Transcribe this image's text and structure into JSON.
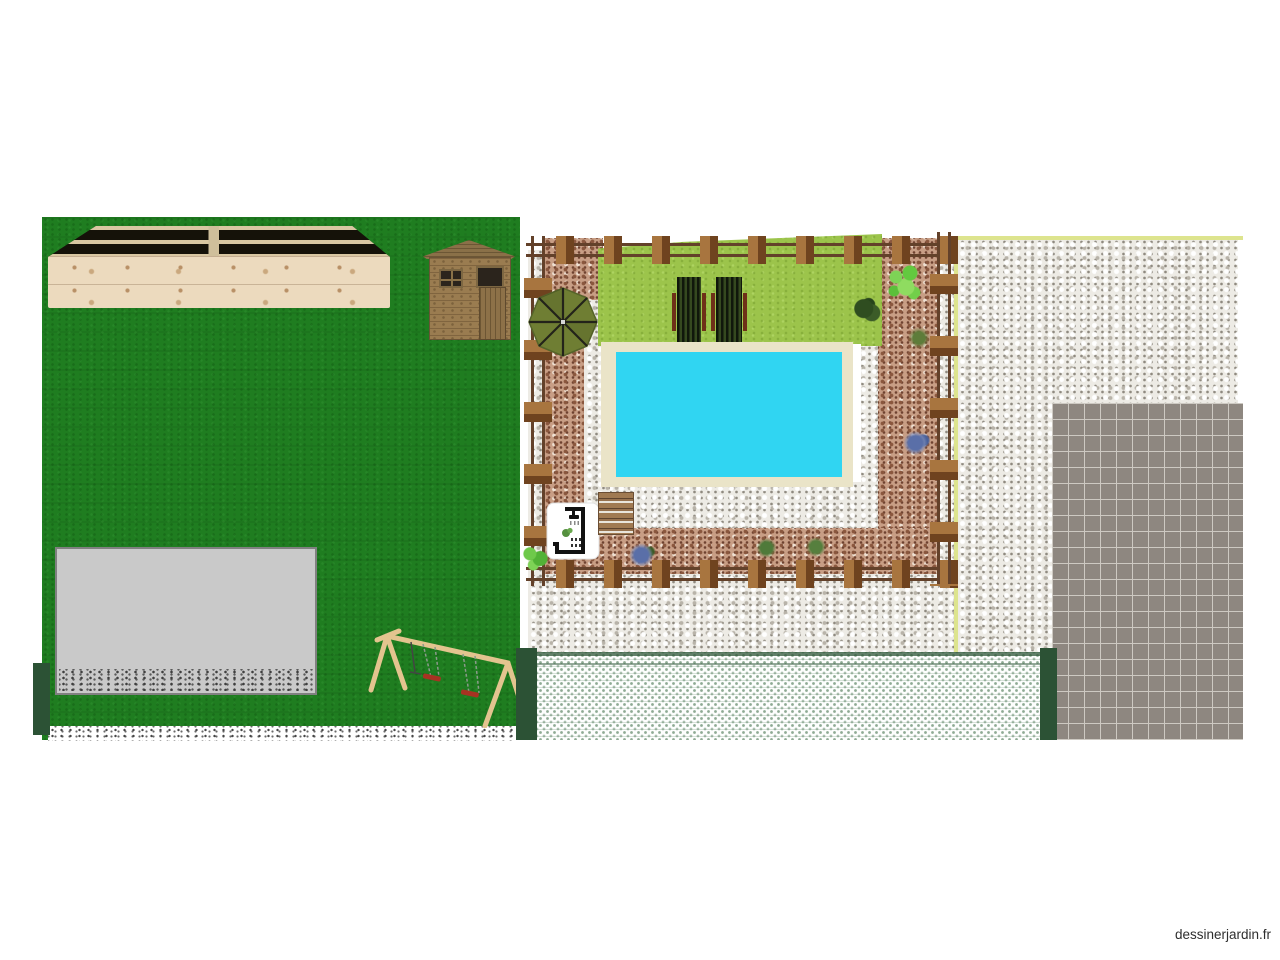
{
  "watermark": {
    "text": "dessinerjardin.fr"
  },
  "palette": {
    "lawn": "#1f7d20",
    "grass": "#9cc44b",
    "pool": "#30d5f2",
    "surround": "#eae4c8",
    "stone": "#edebe5",
    "mulch": "#c89e85",
    "railBar": "#63412a",
    "railPostLight": "#a8753f",
    "railPostDark": "#6f431f",
    "shedWood": "#9a7c50",
    "deckFace": "#ecdabe",
    "terrace": "#c9c9c9",
    "tiles": "#8e8780",
    "hedgeGreen": "#3d6b4a",
    "darkPost": "#2c5235",
    "swingWood": "#e3c48f",
    "seatRed": "#a83222",
    "parasol": "#6f7e33",
    "boundary": "#dde48e",
    "watermarkColor": "#2e2e2e"
  },
  "objects": {
    "lawn": "lawn",
    "raised_deck": "wooden raised deck",
    "shed": "garden shed",
    "pergola": "wooden pergola frame",
    "mulch_border": "bark mulch border",
    "gravel": "white gravel",
    "lawn_patch": "lawn patch",
    "loungers": "sun loungers",
    "pool": "swimming pool",
    "parasol": "parasol",
    "shower_card": "outdoor shower plan card",
    "pallet": "wood pallet",
    "plants": "shrubs and flowers",
    "terrace": "paved terrace",
    "swing": "swing set",
    "hedge": "hedge strip",
    "tiles": "tiled driveway",
    "posts": "green fence posts"
  }
}
